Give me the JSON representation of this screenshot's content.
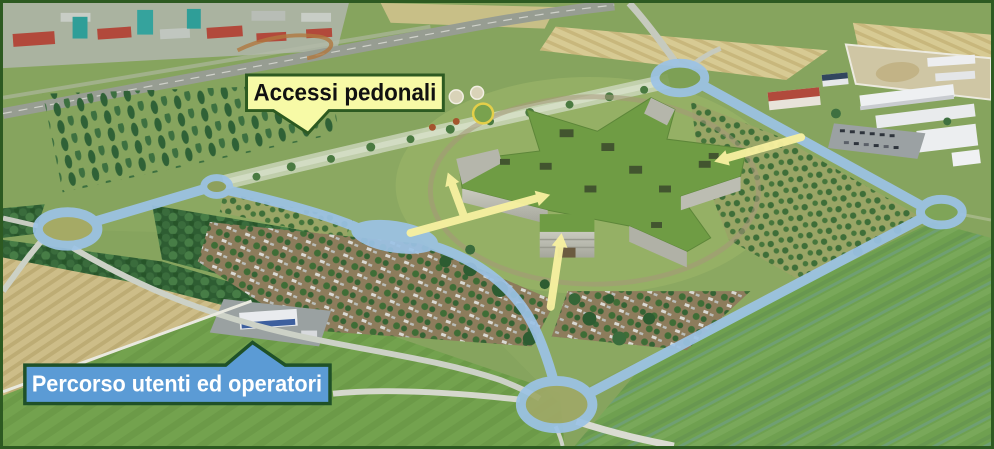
{
  "callouts": {
    "pedestrian_access": {
      "label": "Accessi pedonali",
      "fill": "#F7FAA6",
      "border": "#2D5A21",
      "text_color": "#111111"
    },
    "user_route": {
      "label": "Percorso utenti ed operatori",
      "fill": "#5B9BD5",
      "border": "#1F5128",
      "text_color": "#FFFFFF"
    }
  },
  "overlay": {
    "route_color": "#9CC3E6",
    "arrow_color": "#F8F1A0",
    "roundabout_nodes": 5,
    "access_arrows": 4
  },
  "frame": {
    "border_color": "#2D5A21"
  }
}
